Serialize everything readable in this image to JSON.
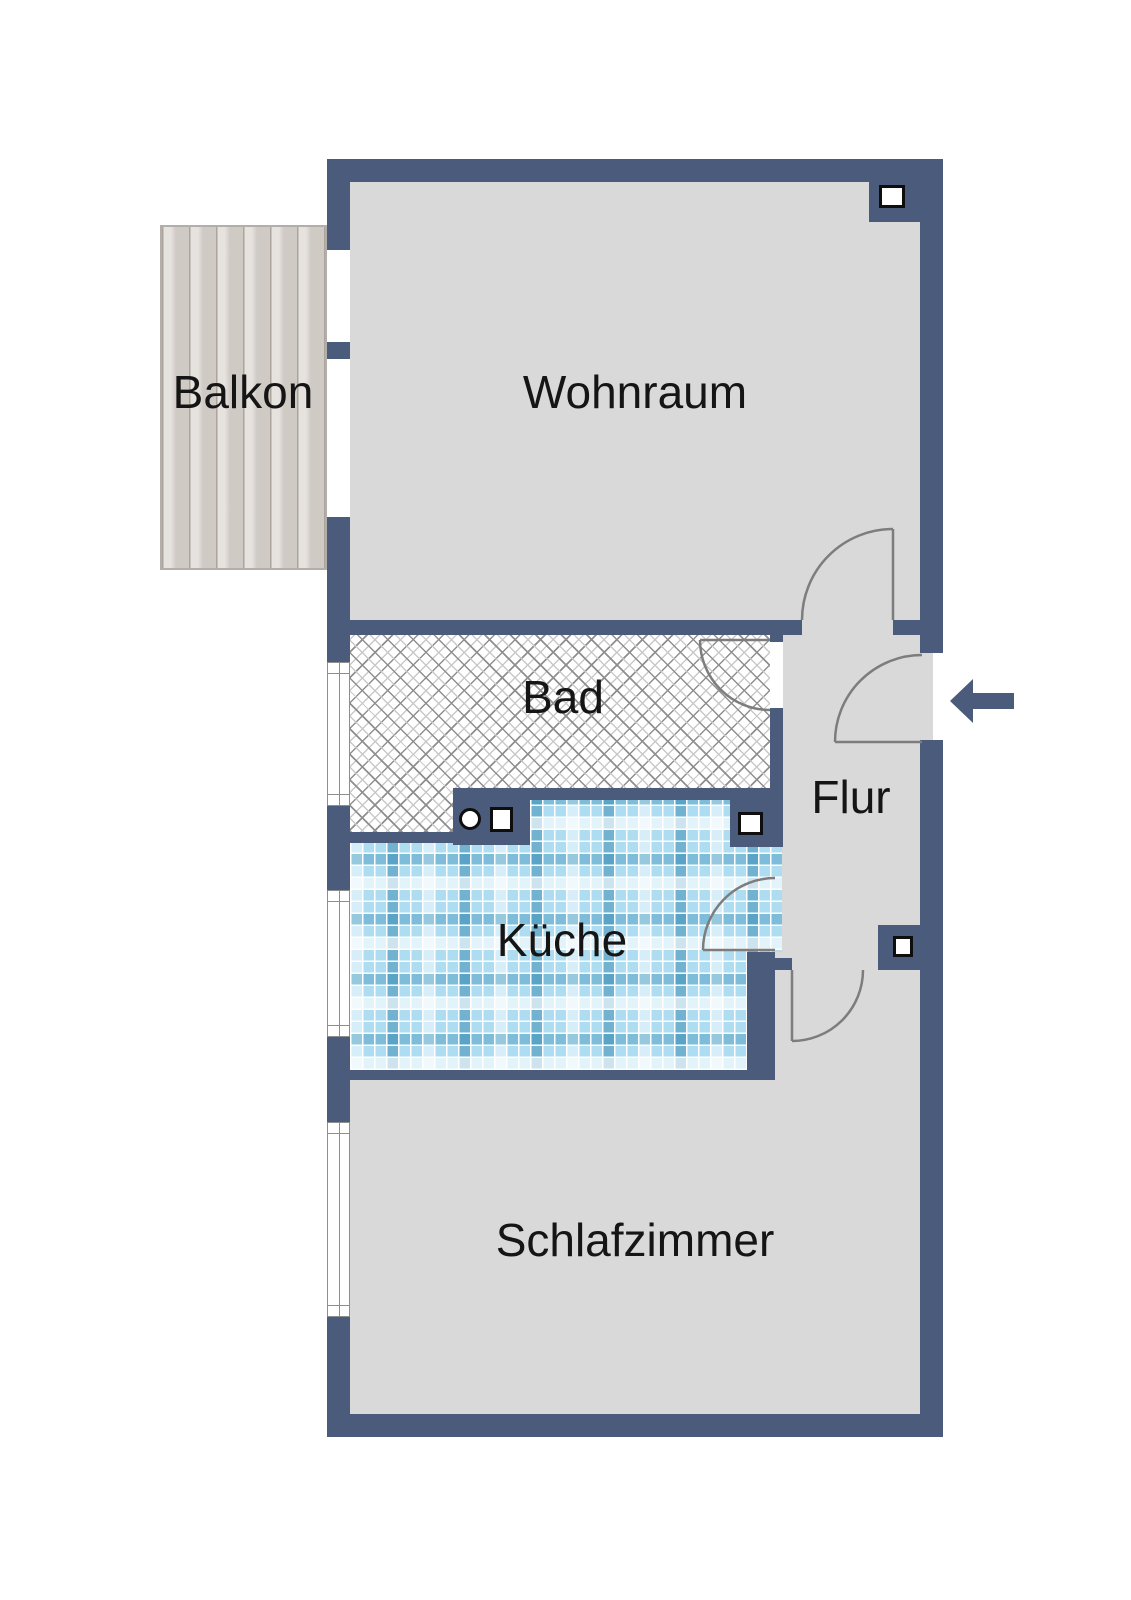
{
  "floorplan": {
    "rooms": [
      {
        "id": "balkon",
        "label": "Balkon"
      },
      {
        "id": "wohnraum",
        "label": "Wohnraum"
      },
      {
        "id": "bad",
        "label": "Bad"
      },
      {
        "id": "flur",
        "label": "Flur"
      },
      {
        "id": "kueche",
        "label": "Küche"
      },
      {
        "id": "schlafzimmer",
        "label": "Schlafzimmer"
      }
    ],
    "colors": {
      "wall": "#4a5b7c",
      "floor": "#d9d9d9",
      "bath_floor": "#ffffff",
      "hatch_line": "#8f8f8f",
      "kitchen_tile": "#aedcf0",
      "balcony_wood": "#d8d2cd",
      "door_arc": "#7d7d7d",
      "label_text": "#151515",
      "entrance_arrow": "#4a5b7c"
    },
    "symbols": [
      "entrance-arrow-icon",
      "door-swing-arc",
      "window-glyph",
      "shaft-square-symbol",
      "fixture-circle-symbol"
    ]
  }
}
